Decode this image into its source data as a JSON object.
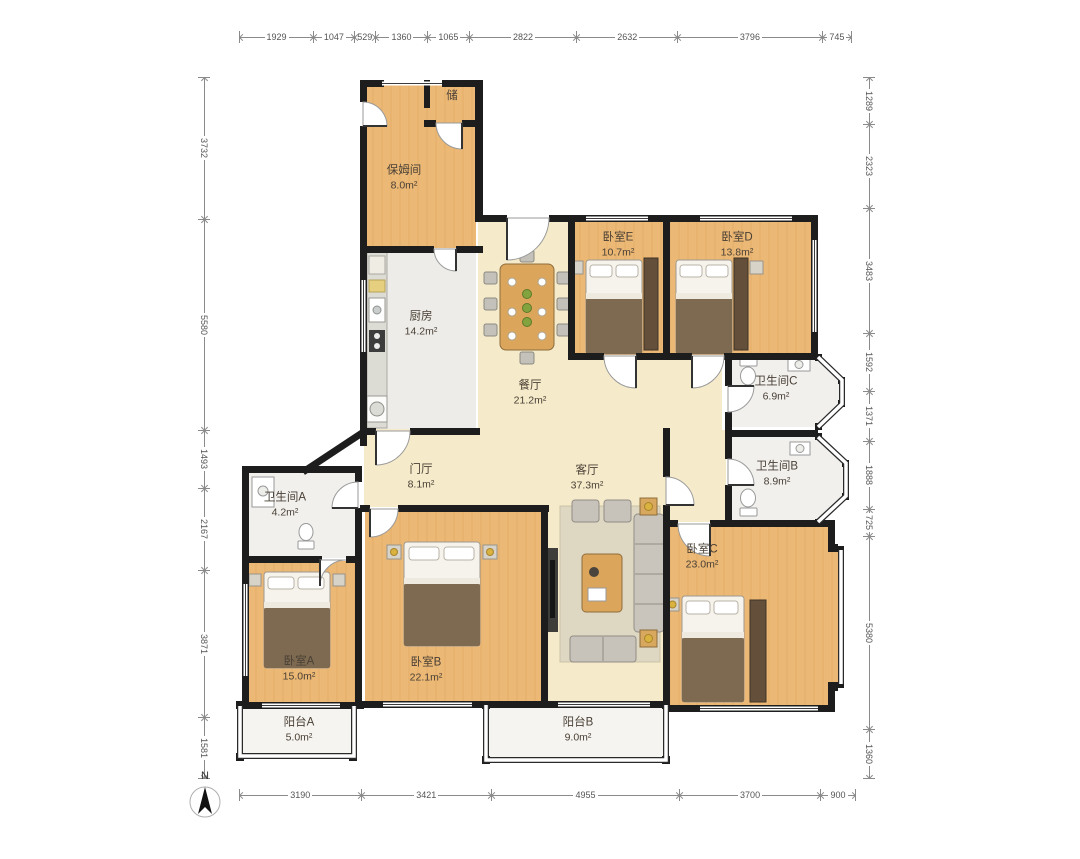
{
  "compass": {
    "label": "N"
  },
  "rooms": [
    {
      "name": "储",
      "area": ""
    },
    {
      "name": "保姆间",
      "area": "8.0m²"
    },
    {
      "name": "厨房",
      "area": "14.2m²"
    },
    {
      "name": "卧室E",
      "area": "10.7m²"
    },
    {
      "name": "卧室D",
      "area": "13.8m²"
    },
    {
      "name": "餐厅",
      "area": "21.2m²"
    },
    {
      "name": "卫生间C",
      "area": "6.9m²"
    },
    {
      "name": "门厅",
      "area": "8.1m²"
    },
    {
      "name": "客厅",
      "area": "37.3m²"
    },
    {
      "name": "卫生间B",
      "area": "8.9m²"
    },
    {
      "name": "卫生间A",
      "area": "4.2m²"
    },
    {
      "name": "卧室C",
      "area": "23.0m²"
    },
    {
      "name": "卧室A",
      "area": "15.0m²"
    },
    {
      "name": "卧室B",
      "area": "22.1m²"
    },
    {
      "name": "阳台A",
      "area": "5.0m²"
    },
    {
      "name": "阳台B",
      "area": "9.0m²"
    }
  ],
  "dimensions": {
    "top": [
      1929,
      1047,
      529,
      1360,
      1065,
      2822,
      2632,
      3796,
      745
    ],
    "bottom": [
      3190,
      3421,
      4955,
      3700,
      900
    ],
    "left": [
      3732,
      5580,
      1493,
      2167,
      3871,
      1581
    ],
    "right": [
      1289,
      2323,
      3483,
      1592,
      1371,
      1888,
      725,
      5380,
      1360
    ]
  },
  "colors": {
    "wall": "#1D1D1D",
    "wood_floor": "#EBB875",
    "cream_floor": "#F5EBCB",
    "tile_floor": "#EDECE8",
    "balcony_floor": "#F5F4F0",
    "furniture_wood": "#DBA55C",
    "blanket": "#7E6A50",
    "lamp": "#D9B23F",
    "plant": "#83A33F",
    "dimension_text": "#555555",
    "label_text": "#4A4036"
  }
}
